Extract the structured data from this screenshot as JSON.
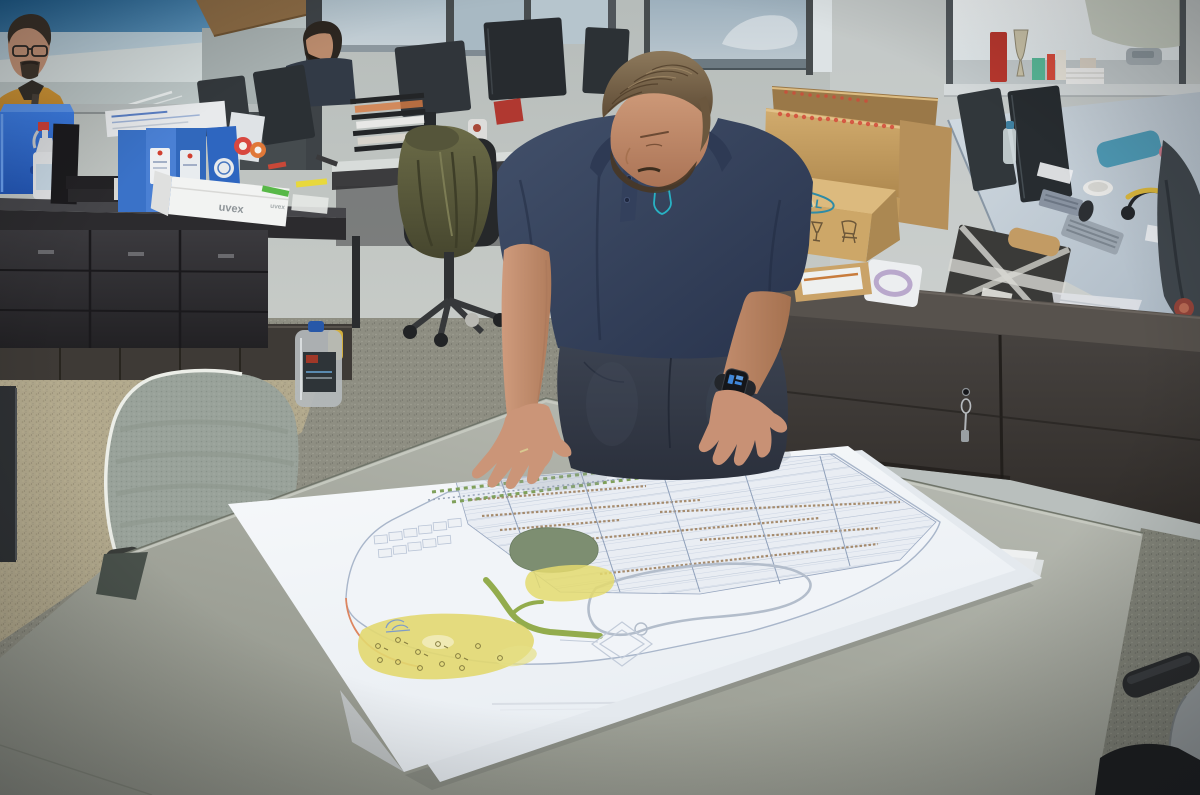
{
  "meta": {
    "title": "Office — engineer reviewing large printed site plan"
  },
  "labels": {
    "uvex": "uvex",
    "signal": "SIGNAL",
    "kris": "KRIS",
    "marker_z": "Z"
  },
  "palette": {
    "polo_navy": "#334059",
    "logo_teal": "#28b2c4",
    "signal_teal": "#2e8ba6",
    "cardboard": "#cda768",
    "blue_box": "#2f6fd6",
    "binder_blue": "#3a72c8",
    "cardigan_mustard": "#c78a2e",
    "jacket_olive": "#5c5a3c",
    "table_gray": "#a0a399",
    "plan_pond_green": "#7d8e71",
    "plan_yellow": "#e2d870",
    "plan_green_strip": "#93ac4d",
    "plan_boundary_orange": "#dd8560",
    "carpet_beige": "#b2a98d",
    "carpet_olive": "#8e8e82"
  },
  "scene": {
    "people_count": 3,
    "objects": [
      "site-plan sheet",
      "gray meeting table",
      "cardboard boxes",
      "sideboard with drawer keys",
      "office monitors",
      "blue archive binders",
      "uvex box",
      "water jug",
      "mesh chair",
      "smartwatch"
    ]
  }
}
